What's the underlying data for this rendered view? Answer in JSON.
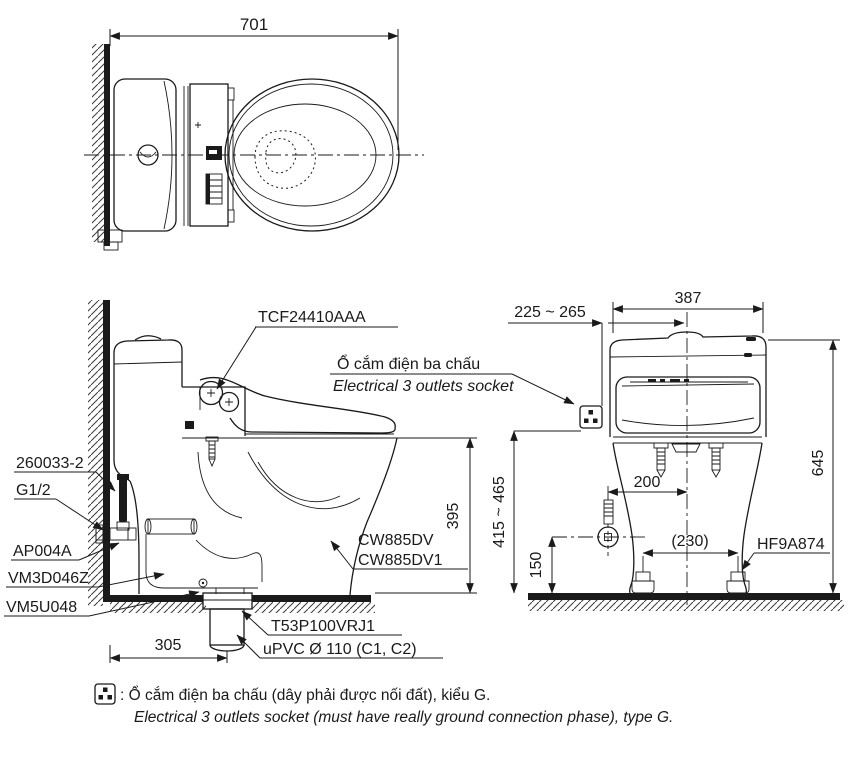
{
  "colors": {
    "line": "#1a1a1a",
    "background": "#ffffff"
  },
  "top_view": {
    "dim_length": "701"
  },
  "side_view": {
    "label_seat": "TCF24410AAA",
    "socket_note_vi": "Ổ cắm điện ba chấu",
    "socket_note_en": "Electrical 3 outlets socket",
    "label_hose": "260033-2",
    "label_thread": "G1/2",
    "label_valve": "AP004A",
    "label_inlet": "VM3D046Z",
    "label_outlet": "VM5U048",
    "label_bowl_1": "CW885DV",
    "label_bowl_2": "CW885DV1",
    "label_joint": "T53P100VRJ1",
    "label_pipe": "uPVC Ø 110 (C1, C2)",
    "dim_rim_height": "395",
    "dim_drain_offset": "305"
  },
  "front_view": {
    "dim_width": "387",
    "dim_socket_offset": "225 ~ 265",
    "dim_total_height": "645",
    "dim_socket_height": "415 ~ 465",
    "dim_supply_offset": "200",
    "dim_supply_height": "150",
    "dim_bolt_spacing": "(230)",
    "label_bolt_cap": "HF9A874"
  },
  "footnote": {
    "vi": ": Ổ cắm điện ba chấu (dây phải được nối đất), kiểu G.",
    "en": "Electrical 3 outlets socket (must have really ground connection phase), type G."
  }
}
